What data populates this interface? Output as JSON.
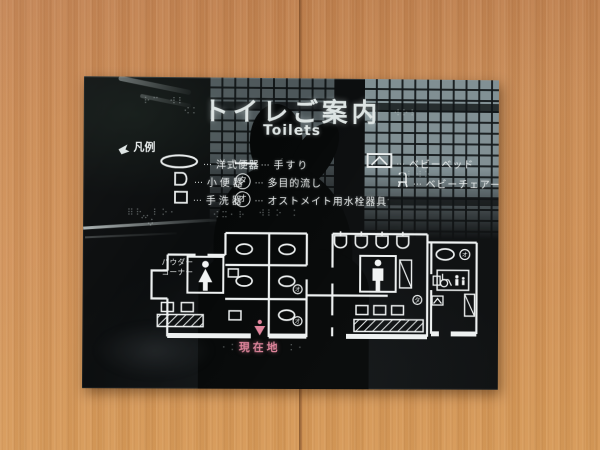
{
  "sign": {
    "title": "トイレご案内",
    "subtitle": "Toilets",
    "legend": {
      "header": "凡例",
      "separator": "…",
      "col1": [
        {
          "label": "洋式便器"
        },
        {
          "label": "小便器"
        },
        {
          "label": "手洗器"
        }
      ],
      "col2": [
        {
          "label": "手すり"
        },
        {
          "mark": "タ",
          "label": "多目的流し"
        },
        {
          "mark": "オ",
          "label": "オストメイト用水栓器具"
        }
      ],
      "col3": [
        {
          "label": "ベビーベッド"
        },
        {
          "label": "ベビーチェアー"
        }
      ]
    },
    "map": {
      "powder_line1": "パウダー",
      "powder_line2": "コーナー",
      "current_location": "現在地",
      "mark_multipurpose": "タ",
      "mark_ostomate": "オ"
    },
    "colors": {
      "accent_pink": "#e0849b",
      "line_white": "#eef1f1",
      "wood": "#cd8b53",
      "sign_black": "#0b0d0e"
    },
    "braille": [
      "⠗⠉⠀⠺⠇",
      "⠪⠅",
      "⠺⠕⠇",
      "⠿⠗⠀⠇⠕⠂",
      "⠪⠭⠂⠗",
      "⠺⠇⠕⠀⠅",
      "⠗⠅⠂",
      "⠇⠺⠕",
      "⠞⠵",
      "⠂⠅",
      "⠅⠂",
      "⠇⠂"
    ]
  }
}
